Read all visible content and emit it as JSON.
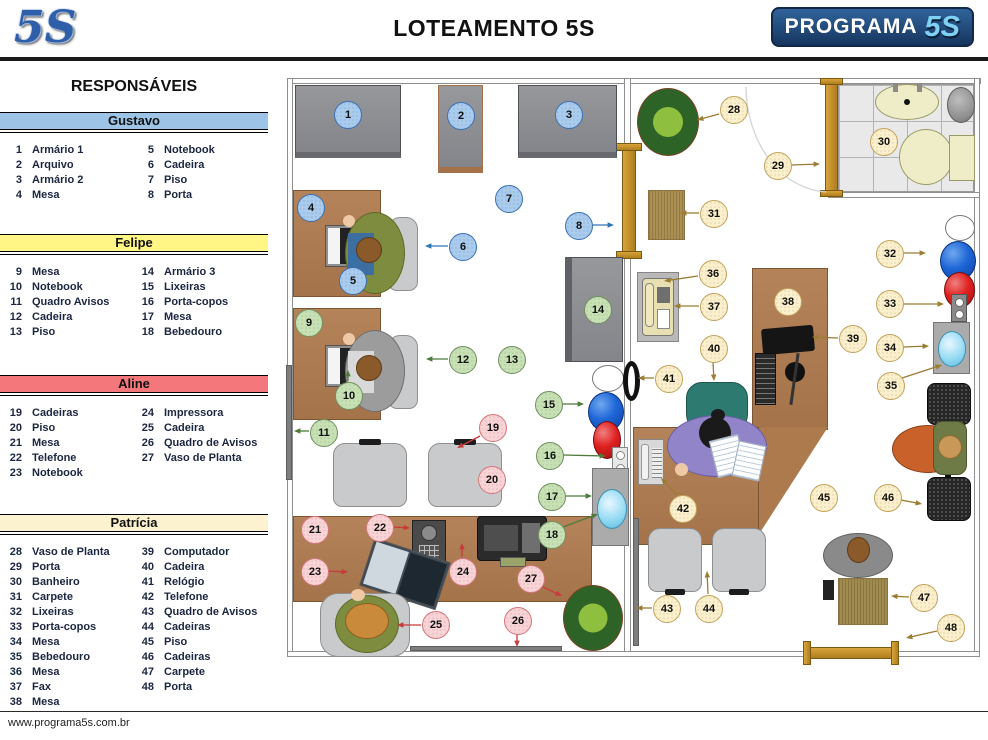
{
  "header": {
    "logo_left": "5S",
    "title": "LOTEAMENTO 5S",
    "logo_right_text": "PROGRAMA",
    "logo_right_5s": "5S"
  },
  "footer": {
    "url": "www.programa5s.com.br"
  },
  "sidebar": {
    "title": "RESPONSÁVEIS",
    "sections": [
      {
        "name": "Gustavo",
        "color": "#9dc3e6",
        "items": [
          [
            1,
            "Armário 1"
          ],
          [
            2,
            "Arquivo"
          ],
          [
            3,
            "Armário 2"
          ],
          [
            4,
            "Mesa"
          ],
          [
            5,
            "Notebook"
          ],
          [
            6,
            "Cadeira"
          ],
          [
            7,
            "Piso"
          ],
          [
            8,
            "Porta"
          ]
        ]
      },
      {
        "name": "Felipe",
        "color": "#fff685",
        "items": [
          [
            9,
            "Mesa"
          ],
          [
            10,
            "Notebook"
          ],
          [
            11,
            "Quadro Avisos"
          ],
          [
            12,
            "Cadeira"
          ],
          [
            13,
            "Piso"
          ],
          [
            14,
            "Armário 3"
          ],
          [
            15,
            "Lixeiras"
          ],
          [
            16,
            "Porta-copos"
          ],
          [
            17,
            "Mesa"
          ],
          [
            18,
            "Bebedouro"
          ]
        ]
      },
      {
        "name": "Aline",
        "color": "#f4787b",
        "items": [
          [
            19,
            "Cadeiras"
          ],
          [
            20,
            "Piso"
          ],
          [
            21,
            "Mesa"
          ],
          [
            22,
            "Telefone"
          ],
          [
            23,
            "Notebook"
          ],
          [
            24,
            "Impressora"
          ],
          [
            25,
            "Cadeira"
          ],
          [
            26,
            "Quadro de Avisos"
          ],
          [
            27,
            "Vaso de Planta"
          ]
        ]
      },
      {
        "name": "Patrícia",
        "color": "#fdf2cf",
        "items": [
          [
            28,
            "Vaso de Planta"
          ],
          [
            29,
            "Porta"
          ],
          [
            30,
            "Banheiro"
          ],
          [
            31,
            "Carpete"
          ],
          [
            32,
            "Lixeiras"
          ],
          [
            33,
            "Porta-copos"
          ],
          [
            34,
            "Mesa"
          ],
          [
            35,
            "Bebedouro"
          ],
          [
            36,
            "Mesa"
          ],
          [
            37,
            "Fax"
          ],
          [
            38,
            "Mesa"
          ],
          [
            39,
            "Computador"
          ],
          [
            40,
            "Cadeira"
          ],
          [
            41,
            "Relógio"
          ],
          [
            42,
            "Telefone"
          ],
          [
            43,
            "Quadro de Avisos"
          ],
          [
            44,
            "Cadeiras"
          ],
          [
            45,
            "Piso"
          ],
          [
            46,
            "Cadeiras"
          ],
          [
            47,
            "Carpete"
          ],
          [
            48,
            "Porta"
          ]
        ]
      }
    ]
  },
  "floor_plan": {
    "groups": {
      "g": {
        "owner": "Gustavo",
        "fill": "#a9cbee",
        "border": "#3a70b2",
        "arrow": "#2e75b6"
      },
      "f": {
        "owner": "Felipe",
        "fill": "#c7e1b5",
        "border": "#70905f",
        "arrow": "#4e7a3a"
      },
      "a": {
        "owner": "Aline",
        "fill": "#f9d3d5",
        "border": "#d4767b",
        "arrow": "#c83a3a"
      },
      "p": {
        "owner": "Patrícia",
        "fill": "#fbf0cb",
        "border": "#c2a35c",
        "arrow": "#9c7c31"
      }
    },
    "markers": [
      {
        "n": 1,
        "g": "g",
        "x": 62,
        "y": 49
      },
      {
        "n": 2,
        "g": "g",
        "x": 175,
        "y": 50
      },
      {
        "n": 3,
        "g": "g",
        "x": 283,
        "y": 49
      },
      {
        "n": 4,
        "g": "g",
        "x": 25,
        "y": 142
      },
      {
        "n": 5,
        "g": "g",
        "x": 67,
        "y": 215,
        "arrow": [
          67,
          201,
          67,
          188
        ]
      },
      {
        "n": 6,
        "g": "g",
        "x": 177,
        "y": 181,
        "arrow": [
          163,
          181,
          140,
          181
        ]
      },
      {
        "n": 7,
        "g": "g",
        "x": 223,
        "y": 133
      },
      {
        "n": 8,
        "g": "g",
        "x": 293,
        "y": 160,
        "arrow": [
          307,
          160,
          329,
          160
        ]
      },
      {
        "n": 9,
        "g": "f",
        "x": 23,
        "y": 257
      },
      {
        "n": 10,
        "g": "f",
        "x": 63,
        "y": 330,
        "arrow": [
          63,
          316,
          63,
          305
        ]
      },
      {
        "n": 11,
        "g": "f",
        "x": 38,
        "y": 367,
        "arrow": [
          24,
          366,
          9,
          366
        ]
      },
      {
        "n": 12,
        "g": "f",
        "x": 177,
        "y": 294,
        "arrow": [
          163,
          294,
          141,
          294
        ]
      },
      {
        "n": 13,
        "g": "f",
        "x": 226,
        "y": 294
      },
      {
        "n": 14,
        "g": "f",
        "x": 312,
        "y": 244
      },
      {
        "n": 15,
        "g": "f",
        "x": 263,
        "y": 339,
        "arrow": [
          277,
          339,
          299,
          339
        ]
      },
      {
        "n": 16,
        "g": "f",
        "x": 264,
        "y": 390,
        "arrow": [
          278,
          390,
          321,
          391
        ]
      },
      {
        "n": 17,
        "g": "f",
        "x": 266,
        "y": 431,
        "arrow": [
          280,
          431,
          307,
          431
        ]
      },
      {
        "n": 18,
        "g": "f",
        "x": 266,
        "y": 469,
        "arrow": [
          278,
          462,
          313,
          449
        ]
      },
      {
        "n": 19,
        "g": "a",
        "x": 207,
        "y": 362,
        "arrow": [
          195,
          371,
          172,
          383
        ]
      },
      {
        "n": 20,
        "g": "a",
        "x": 206,
        "y": 414
      },
      {
        "n": 21,
        "g": "a",
        "x": 29,
        "y": 464
      },
      {
        "n": 22,
        "g": "a",
        "x": 94,
        "y": 462,
        "arrow": [
          108,
          462,
          125,
          463
        ]
      },
      {
        "n": 23,
        "g": "a",
        "x": 29,
        "y": 506,
        "arrow": [
          43,
          506,
          63,
          507
        ]
      },
      {
        "n": 24,
        "g": "a",
        "x": 177,
        "y": 506,
        "arrow": [
          177,
          492,
          177,
          478
        ]
      },
      {
        "n": 25,
        "g": "a",
        "x": 150,
        "y": 559,
        "arrow": [
          136,
          560,
          112,
          560
        ]
      },
      {
        "n": 26,
        "g": "a",
        "x": 232,
        "y": 555,
        "arrow": [
          232,
          569,
          232,
          582
        ]
      },
      {
        "n": 27,
        "g": "a",
        "x": 245,
        "y": 513,
        "arrow": [
          256,
          521,
          277,
          531
        ]
      },
      {
        "n": 28,
        "g": "p",
        "x": 448,
        "y": 44,
        "arrow": [
          434,
          49,
          412,
          55
        ]
      },
      {
        "n": 29,
        "g": "p",
        "x": 492,
        "y": 100,
        "arrow": [
          506,
          100,
          535,
          99
        ]
      },
      {
        "n": 30,
        "g": "p",
        "x": 598,
        "y": 76
      },
      {
        "n": 31,
        "g": "p",
        "x": 428,
        "y": 148,
        "arrow": [
          414,
          148,
          395,
          148
        ]
      },
      {
        "n": 32,
        "g": "p",
        "x": 604,
        "y": 188,
        "arrow": [
          618,
          188,
          641,
          188
        ]
      },
      {
        "n": 33,
        "g": "p",
        "x": 604,
        "y": 238,
        "arrow": [
          618,
          239,
          659,
          239
        ]
      },
      {
        "n": 34,
        "g": "p",
        "x": 604,
        "y": 282,
        "arrow": [
          618,
          282,
          644,
          281
        ]
      },
      {
        "n": 35,
        "g": "p",
        "x": 605,
        "y": 320,
        "arrow": [
          617,
          313,
          657,
          300
        ]
      },
      {
        "n": 36,
        "g": "p",
        "x": 427,
        "y": 208,
        "arrow": [
          413,
          211,
          379,
          216
        ]
      },
      {
        "n": 37,
        "g": "p",
        "x": 428,
        "y": 241,
        "arrow": [
          414,
          241,
          389,
          241
        ]
      },
      {
        "n": 38,
        "g": "p",
        "x": 502,
        "y": 236
      },
      {
        "n": 39,
        "g": "p",
        "x": 567,
        "y": 273,
        "arrow": [
          553,
          273,
          527,
          272
        ]
      },
      {
        "n": 40,
        "g": "p",
        "x": 428,
        "y": 283,
        "arrow": [
          428,
          297,
          429,
          316
        ]
      },
      {
        "n": 41,
        "g": "p",
        "x": 383,
        "y": 313,
        "arrow": [
          369,
          313,
          353,
          313
        ]
      },
      {
        "n": 42,
        "g": "p",
        "x": 397,
        "y": 443,
        "arrow": [
          392,
          430,
          376,
          413
        ]
      },
      {
        "n": 43,
        "g": "p",
        "x": 381,
        "y": 543,
        "arrow": [
          367,
          543,
          351,
          543
        ]
      },
      {
        "n": 44,
        "g": "p",
        "x": 423,
        "y": 543,
        "arrow": [
          423,
          529,
          422,
          506
        ]
      },
      {
        "n": 45,
        "g": "p",
        "x": 538,
        "y": 432
      },
      {
        "n": 46,
        "g": "p",
        "x": 602,
        "y": 432,
        "arrow": [
          616,
          435,
          637,
          439
        ]
      },
      {
        "n": 47,
        "g": "p",
        "x": 638,
        "y": 532,
        "arrow": [
          624,
          532,
          606,
          531
        ]
      },
      {
        "n": 48,
        "g": "p",
        "x": 665,
        "y": 562,
        "arrow": [
          652,
          566,
          621,
          573
        ]
      }
    ]
  }
}
